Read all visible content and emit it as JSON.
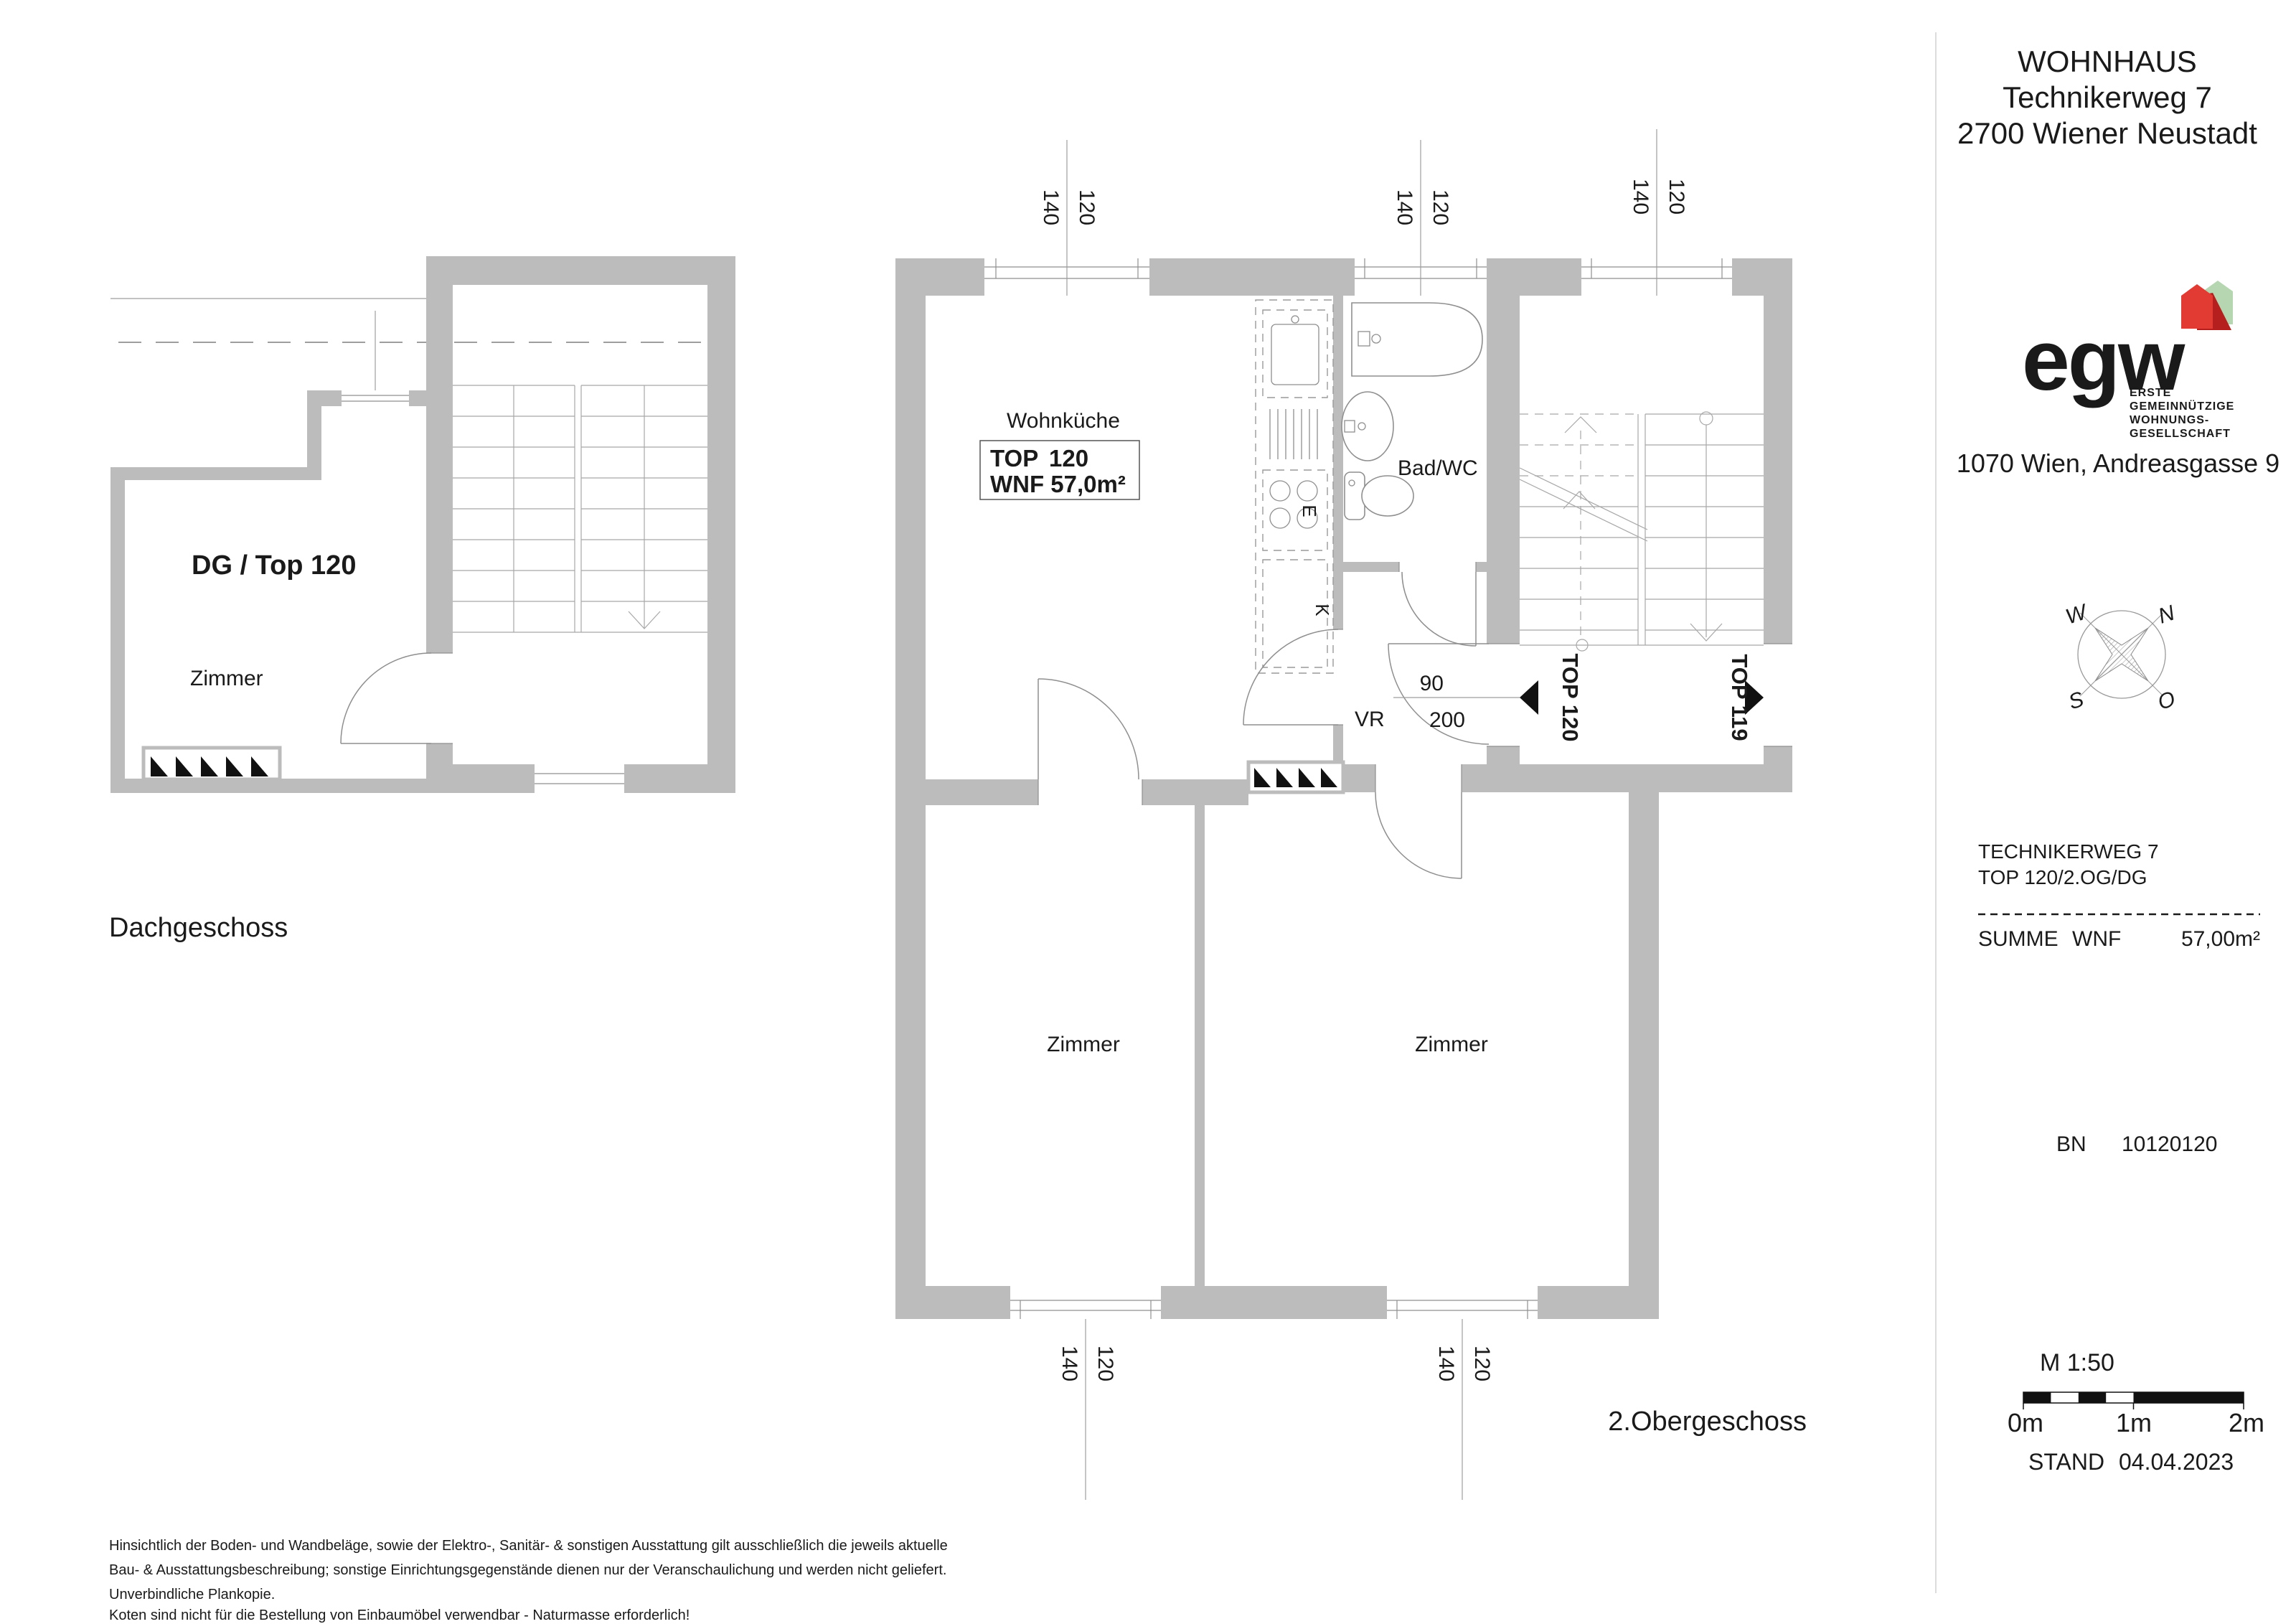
{
  "title_block": {
    "project": {
      "line1": "WOHNHAUS",
      "line2": "Technikerweg 7",
      "line3": "2700 Wiener Neustadt"
    },
    "logo": {
      "name": "egw",
      "sub1": "ERSTE",
      "sub2": "GEMEINNÜTZIGE",
      "sub3": "WOHNUNGS-",
      "sub4": "GESELLSCHAFT",
      "address": "1070 Wien, Andreasgasse 9",
      "blue": "#1e3a82",
      "red": "#e23b33",
      "dark_red": "#b5201f",
      "green": "#b5d6b0"
    },
    "compass": {
      "n": "N",
      "s": "S",
      "w": "W",
      "o": "O"
    },
    "info": {
      "street": "TECHNIKERWEG 7",
      "unit": "TOP 120/2.OG/DG",
      "summe_label": "SUMME",
      "summe_label2": "WNF",
      "summe_value": "57,00m²"
    },
    "bn": {
      "label": "BN",
      "value": "10120120"
    },
    "scale": {
      "label": "M 1:50",
      "m0": "0m",
      "m1": "1m",
      "m2": "2m"
    },
    "stand": {
      "label": "STAND",
      "value": "04.04.2023"
    }
  },
  "plan_dg": {
    "title": "DG / Top 120",
    "room": "Zimmer",
    "caption": "Dachgeschoss"
  },
  "plan_og": {
    "caption": "2.Obergeschoss",
    "rooms": {
      "wohnkueche": "Wohnküche",
      "bad": "Bad/WC",
      "vr": "VR",
      "zimmer1": "Zimmer",
      "zimmer2": "Zimmer"
    },
    "unit_box": {
      "label": "TOP",
      "number": "120",
      "line2": "WNF 57,0m²"
    },
    "door": {
      "width": "90",
      "height": "200"
    },
    "entry_self": "TOP 120",
    "entry_neighbor": "TOP 119",
    "kitchen": {
      "e": "E",
      "k": "K"
    },
    "dim": {
      "w": "120",
      "h": "140"
    },
    "wall_color": "#bcbcbc"
  },
  "footer": {
    "line1": "Hinsichtlich der Boden- und Wandbeläge, sowie der Elektro-, Sanitär- & sonstigen Ausstattung gilt ausschließlich die jeweils aktuelle",
    "line2": "Bau- & Ausstattungsbeschreibung; sonstige Einrichtungsgegenstände dienen nur der Veranschaulichung und werden nicht geliefert.",
    "line3": "Unverbindliche Plankopie.",
    "line4": "Koten sind nicht für die Bestellung von Einbaumöbel verwendbar - Naturmasse erforderlich!"
  }
}
